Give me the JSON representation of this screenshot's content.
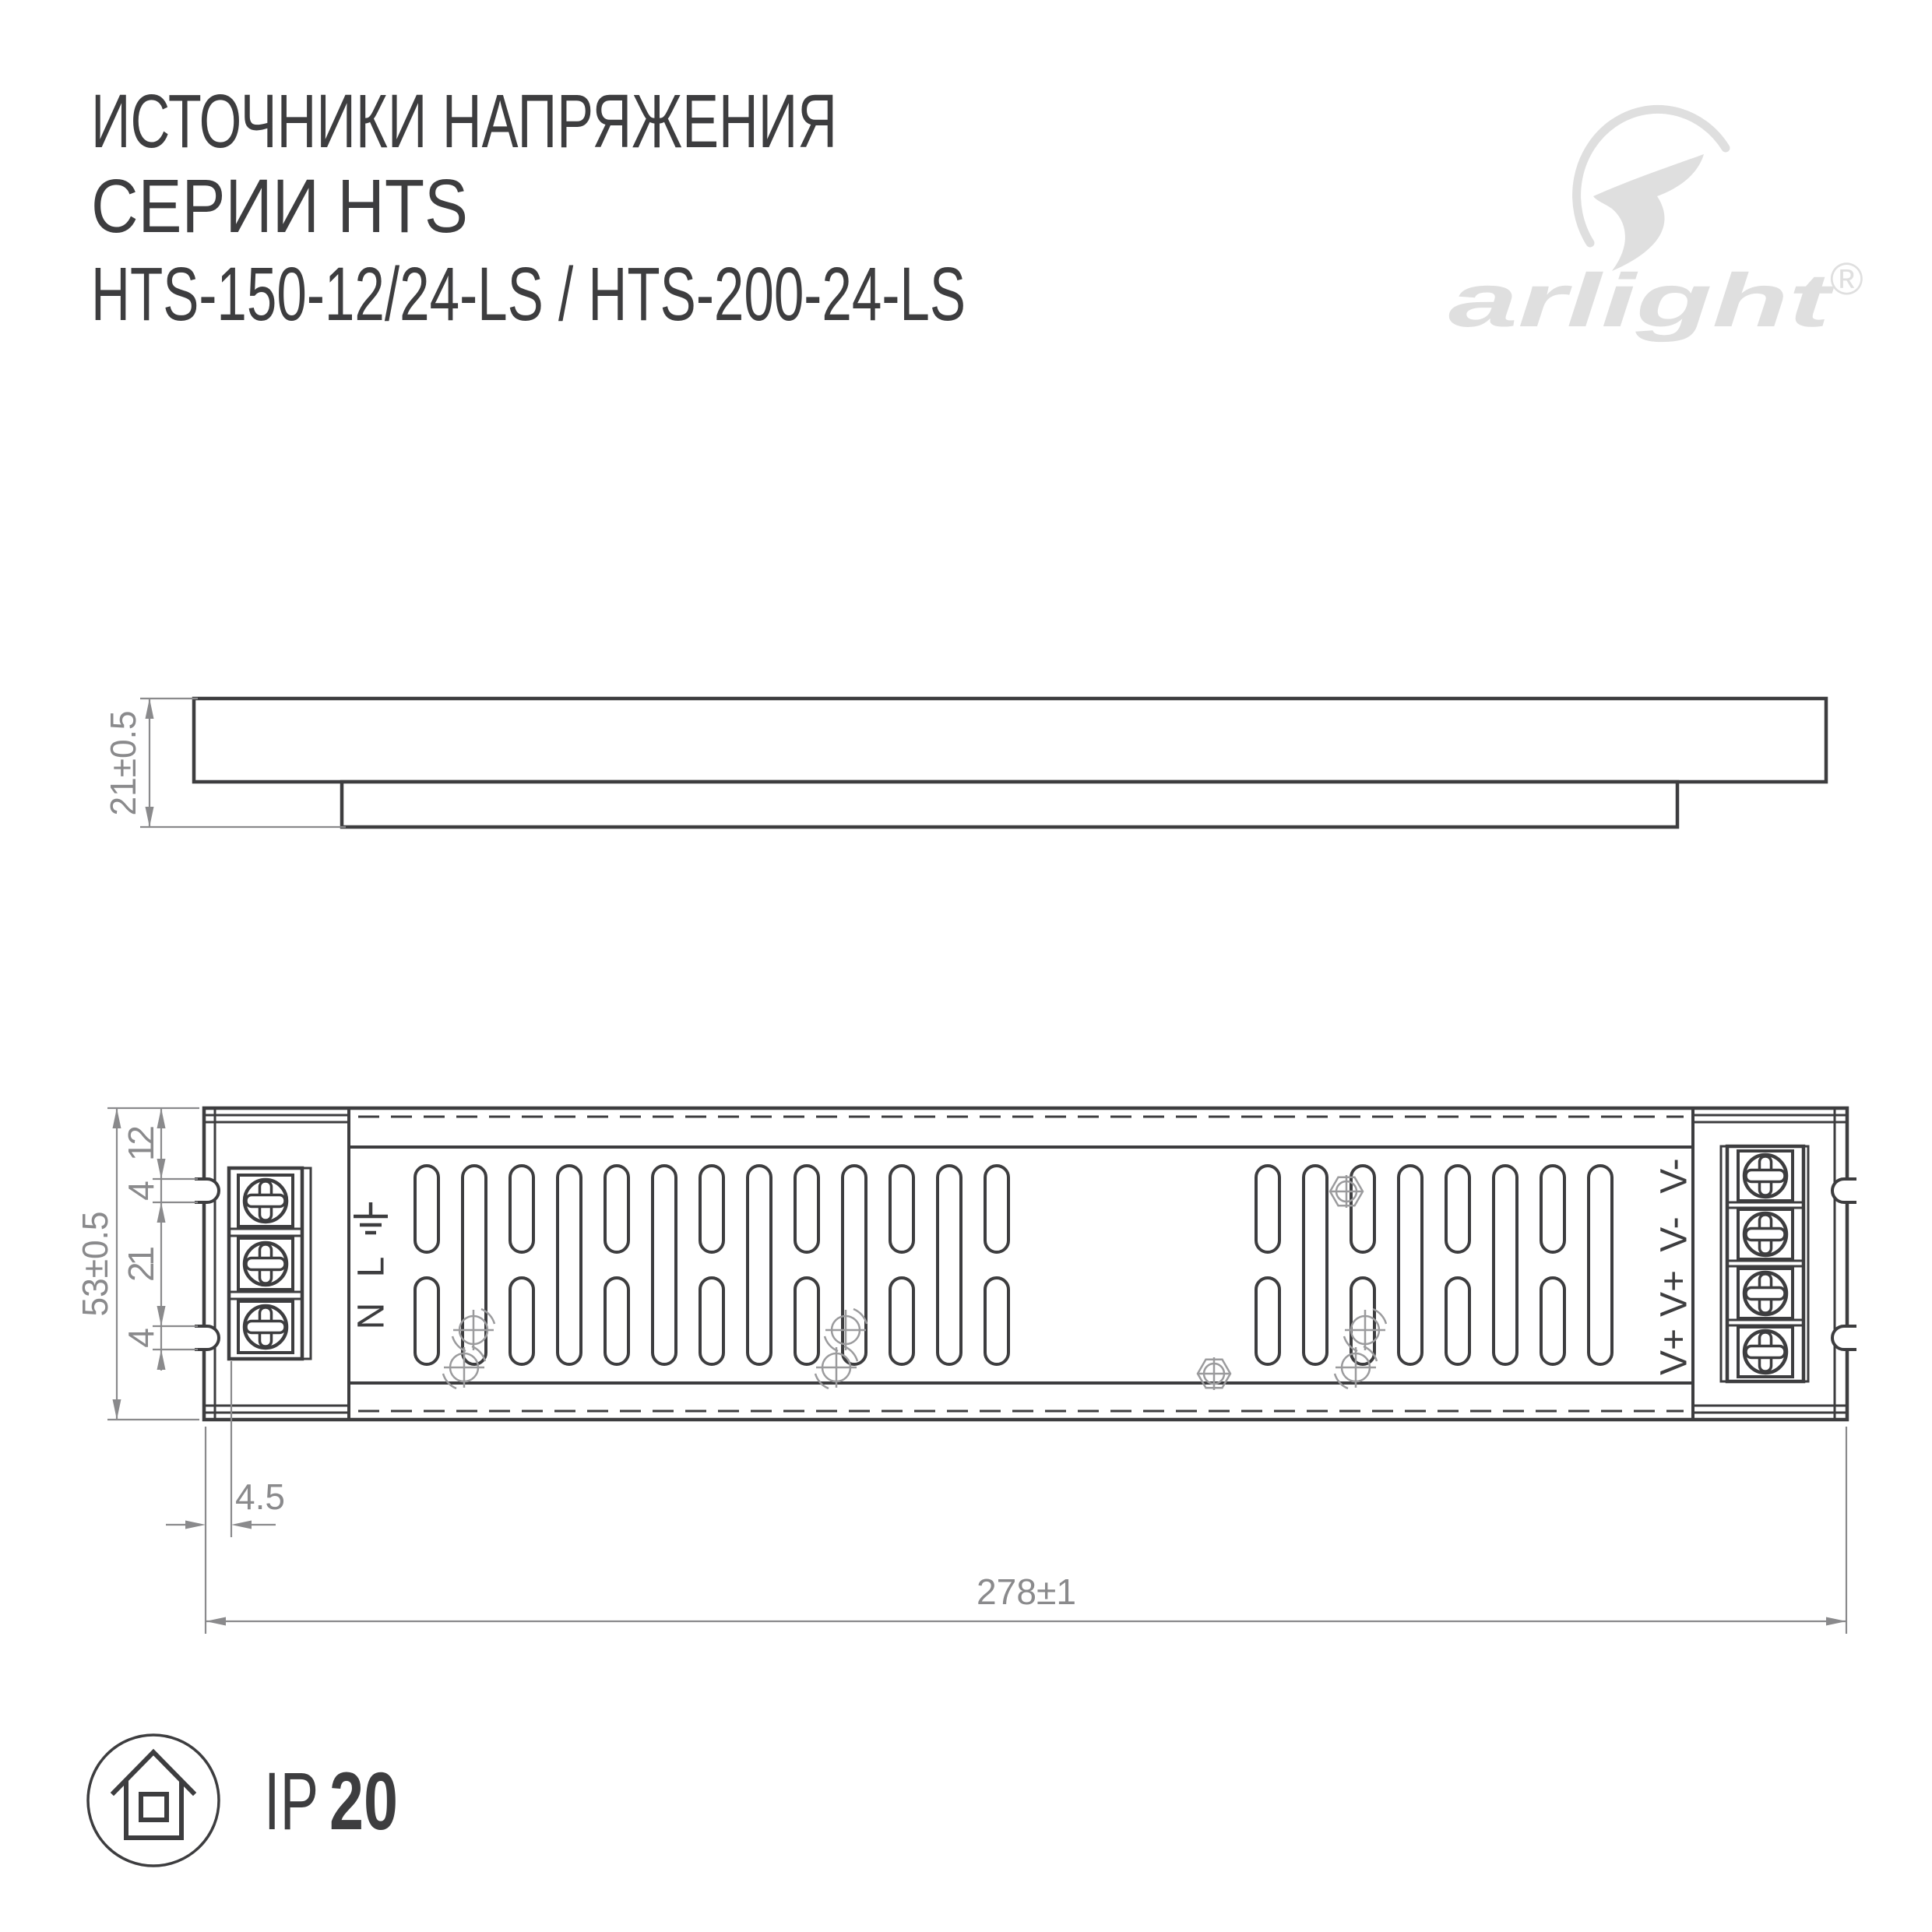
{
  "title": {
    "line1": "ИСТОЧНИКИ НАПРЯЖЕНИЯ",
    "line2": "СЕРИИ HTS",
    "line3": "HTS-150-12/24-LS / HTS-200-24-LS"
  },
  "brand": {
    "wordmark": "arlight",
    "registered": "®"
  },
  "side_view": {
    "height_dim": "21±0.5"
  },
  "top_view": {
    "height_dim": "53±0.5",
    "chain_dims": [
      "12",
      "4",
      "21",
      "4"
    ],
    "offset_dim": "4.5",
    "length_dim": "278±1",
    "input_labels": [
      "L",
      "N"
    ],
    "output_labels": [
      "V-",
      "V-",
      "V+",
      "V+"
    ]
  },
  "ip_rating": {
    "prefix": "IP",
    "value": "20"
  },
  "colors": {
    "line": "#3d3d3f",
    "dimension": "#8a8a8c",
    "fastener": "#9b9b9d",
    "logo": "#dfdfdf"
  }
}
